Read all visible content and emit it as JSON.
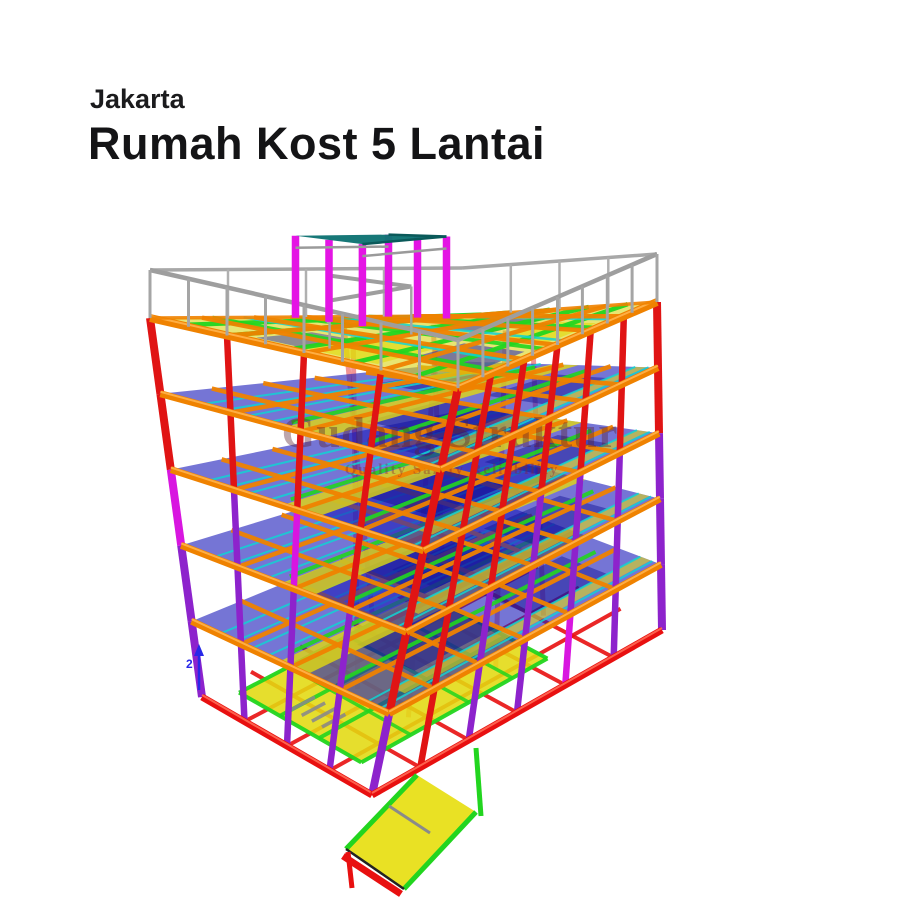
{
  "page": {
    "background": "#ffffff"
  },
  "header": {
    "location": "Jakarta",
    "title": "Rumah Kost 5 Lantai"
  },
  "watermark": {
    "line1": "Gudang Struktur",
    "line2": "Quality Safety Reliability"
  },
  "axis_marker": {
    "label": "2",
    "color": "#2828e8"
  },
  "palette": {
    "red": "#e01414",
    "base_red": "#e81010",
    "orange": "#ef8200",
    "orange_hi": "#ffb24a",
    "purple": "#8d23cc",
    "magenta": "#d816e0",
    "post_magenta": "#e414e4",
    "blue_slab": "#2020bb",
    "navy": "#101090",
    "cyan": "#12d2d2",
    "green": "#22d51f",
    "yellow": "#e2da10",
    "teal": "#0f7474",
    "gray_rail": "#9e9e9e",
    "ramp_yellow": "#e8df18"
  },
  "model": {
    "levels": 6,
    "stories": 5,
    "railing_height": 48,
    "corners": {
      "F": {
        "roof": [
          458,
          388
        ],
        "base": [
          372,
          795
        ]
      },
      "L": {
        "roof": [
          150,
          318
        ],
        "base": [
          202,
          697
        ]
      },
      "R": {
        "roof": [
          657,
          302
        ],
        "base": [
          662,
          630
        ]
      },
      "B": {
        "roof": [
          462,
          316
        ],
        "base": [
          496,
          545
        ]
      }
    },
    "left_columns": [
      {
        "u": 0.0,
        "colors": [
          "red",
          "red",
          "red",
          "red",
          "purple"
        ]
      },
      {
        "u": 0.25,
        "colors": [
          "red",
          "red",
          "red",
          "purple",
          "purple"
        ]
      },
      {
        "u": 0.5,
        "colors": [
          "red",
          "red",
          "magenta",
          "purple",
          "purple"
        ]
      },
      {
        "u": 0.75,
        "colors": [
          "red",
          "red",
          "purple",
          "purple",
          "purple"
        ]
      },
      {
        "u": 1.0,
        "colors": [
          "red",
          "red",
          "magenta",
          "purple",
          "purple"
        ]
      }
    ],
    "right_columns": [
      {
        "v": 0.1667,
        "colors": [
          "red",
          "red",
          "red",
          "red",
          "red"
        ]
      },
      {
        "v": 0.3333,
        "colors": [
          "red",
          "red",
          "red",
          "purple",
          "purple"
        ]
      },
      {
        "v": 0.5,
        "colors": [
          "red",
          "red",
          "purple",
          "purple",
          "purple"
        ]
      },
      {
        "v": 0.6667,
        "colors": [
          "red",
          "red",
          "purple",
          "purple",
          "magenta"
        ]
      },
      {
        "v": 0.8333,
        "colors": [
          "red",
          "red",
          "purple",
          "purple",
          "purple"
        ]
      },
      {
        "v": 1.0,
        "colors": [
          "red",
          "red",
          "purple",
          "purple",
          "purple"
        ]
      }
    ],
    "interior_columns": [
      [
        0.3,
        0.3
      ],
      [
        0.3,
        0.6
      ],
      [
        0.6,
        0.3
      ],
      [
        0.6,
        0.6
      ],
      [
        0.85,
        0.5
      ],
      [
        0.45,
        0.85
      ]
    ],
    "floor_u_beams": [
      0.25,
      0.5,
      0.75
    ],
    "floor_v_beams": [
      0.1667,
      0.3333,
      0.5,
      0.6667,
      0.8333
    ],
    "joists_u": [
      0.05,
      0.12,
      0.62,
      0.7,
      0.78,
      0.86
    ],
    "green_u": [
      0.3,
      0.58
    ],
    "yellow_band_u": [
      0.42,
      0.56
    ],
    "yellow_band2_u": [
      0.06,
      0.12
    ]
  }
}
